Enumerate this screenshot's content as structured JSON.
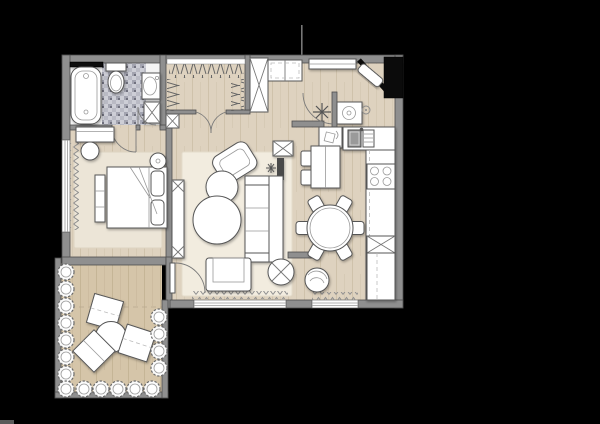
{
  "scene": {
    "type": "architectural-floor-plan-top-view",
    "background": "#000000",
    "visible_text": "",
    "annotations": {
      "section_marker_line": "thin vertical line above top wall",
      "scale_bar_fragment": "small gray sliver bottom-left corner"
    }
  },
  "palette": {
    "background": "#000000",
    "wall": "#8f8f8f",
    "wall_outline": "#4d4d4d",
    "wood_floor": "#ded2bf",
    "wood_grain": "#c9bba3",
    "terrace_floor": "#d5c5a9",
    "terrace_grain": "#bfae8f",
    "bath_tile": "#b9bac4",
    "bath_tile_light": "#cdced6",
    "bath_tile_dark": "#a3a4b0",
    "furniture": "#ffffff",
    "furniture_outline": "#555555",
    "rug_living": "#f2ecdf",
    "rug_bedroom": "#ece5d7",
    "accent_black": "#0b0b0b"
  },
  "rooms": [
    {
      "name": "bathroom",
      "items": [
        "bathtub",
        "toilet",
        "washbasin",
        "vanity-cabinet",
        "mosaic-tile-floor",
        "black-header-panel"
      ]
    },
    {
      "name": "walk-in-closet",
      "items": [
        "hanging-rail-top",
        "hanging-rail-left",
        "hanging-rail-right",
        "shelf",
        "tall-x-cabinet",
        "upper-cabinets",
        "double-door-swing"
      ]
    },
    {
      "name": "hallway",
      "items": [
        "bedroom-door-swing",
        "bathroom-door-swing",
        "entry-door-swing"
      ]
    },
    {
      "name": "entrance",
      "items": [
        "black-entry-door",
        "console-table",
        "washing-machine",
        "plant",
        "utility-cabinet",
        "wall-symbol"
      ]
    },
    {
      "name": "kitchen",
      "items": [
        "sink-counter",
        "sink-basin",
        "drainer",
        "side-counter",
        "cooktop-4-burners",
        "refrigerator-x-box",
        "base-cabinets"
      ]
    },
    {
      "name": "dining-area",
      "items": [
        "serving-table",
        "two-side-chairs",
        "round-table",
        "six-chairs",
        "tub-chair",
        "window-curtain"
      ]
    },
    {
      "name": "living-room",
      "items": [
        "area-rug",
        "tv-unit",
        "media-x-box",
        "fireplace-slot",
        "plant-sprig",
        "rotated-armchair",
        "coffee-table-small",
        "coffee-table-large",
        "sofa",
        "front-armchair",
        "x-side-table",
        "window-curtain",
        "balcony-door"
      ]
    },
    {
      "name": "bedroom",
      "items": [
        "area-rug",
        "desk",
        "stool",
        "bench",
        "double-bed",
        "pillows",
        "table-lamp",
        "window-curtain"
      ]
    },
    {
      "name": "terrace",
      "items": [
        "planter-ring",
        "lounger-1",
        "lounger-2",
        "lounger-3",
        "round-table",
        "deck-dashed-joint"
      ]
    }
  ]
}
